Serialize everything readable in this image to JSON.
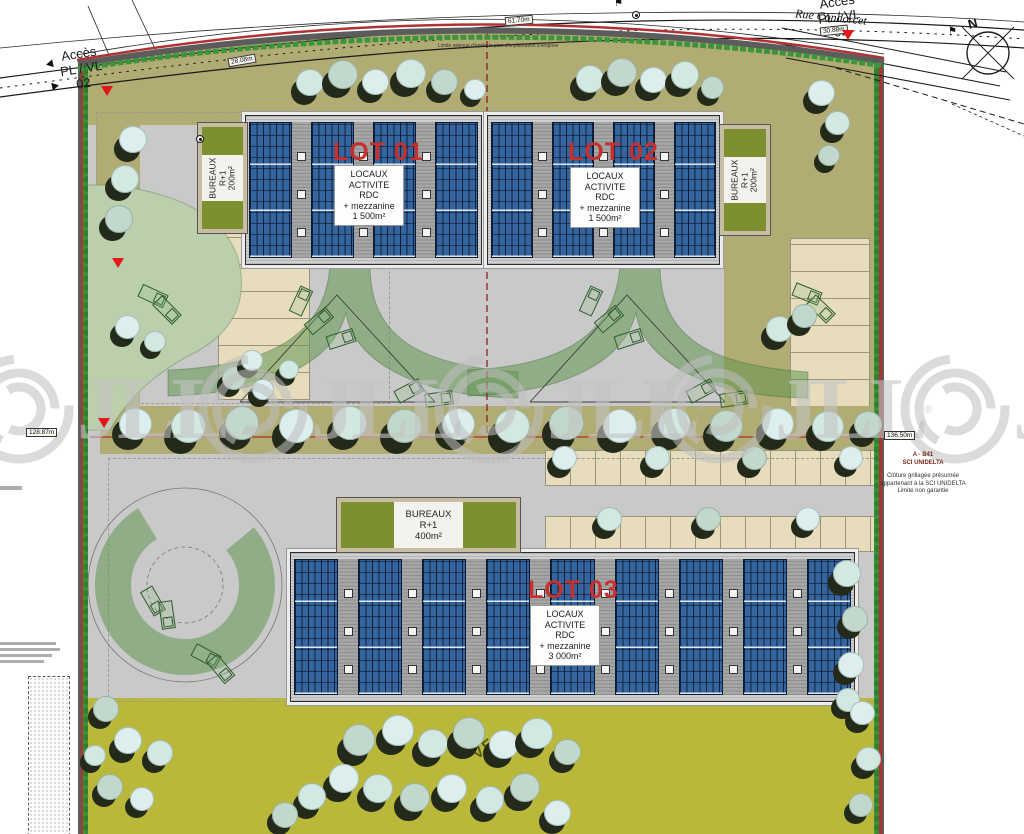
{
  "watermark": {
    "text": "JLL",
    "reg": "®"
  },
  "compass": {
    "label": "N"
  },
  "street": {
    "name": "Rue Condorcet"
  },
  "access_left": {
    "line1": "Accès",
    "line2": "PL / VL",
    "line3": "02"
  },
  "access_right": {
    "line1": "Accès",
    "line2": "PL / VL",
    "line3": "02"
  },
  "dimensions": {
    "top_left": "28.08m",
    "top_center": "61.70m",
    "top_right": "30.88m",
    "left": "128.87m",
    "right": "136.50m"
  },
  "lots": {
    "lot1": {
      "title": "LOT 01",
      "label": [
        "LOCAUX",
        "ACTIVITE",
        "RDC",
        "+ mezzanine",
        "1 500m²"
      ]
    },
    "lot2": {
      "title": "LOT 02",
      "label": [
        "LOCAUX",
        "ACTIVITE",
        "RDC",
        "+ mezzanine",
        "1 500m²"
      ]
    },
    "lot3": {
      "title": "LOT 03",
      "label": [
        "LOCAUX",
        "ACTIVITE",
        "RDC",
        "+ mezzanine",
        "3 000m²"
      ]
    }
  },
  "bureaux": {
    "left": [
      "BUREAUX",
      "R+1",
      "200m²"
    ],
    "right": [
      "BUREAUX",
      "R+1",
      "200m²"
    ],
    "center": [
      "BUREAUX",
      "R+1",
      "400m²"
    ]
  },
  "annotations": {
    "limite": "Limite retenue d'après le plan d'implantation d'emprise",
    "parcel": {
      "line1": "A - B41",
      "line2": "SCI UNIDELTA"
    },
    "cloture": [
      "Clôture grillagée présumée",
      "appartenant à la SCI UNIDELTA",
      "Limite non garantie"
    ],
    "lawn_fragment": "VE"
  },
  "colors": {
    "boundary_red": "#b23232",
    "hedge_green": "#3c943c",
    "asphalt": "#c9c9c9",
    "khaki": "#b1ab74",
    "parking_beige": "#e7ddbd",
    "lawn": "#b9b83a",
    "panel_blue": "#35659f",
    "lot_red": "#c4312e",
    "office_green": "#7d9030"
  }
}
